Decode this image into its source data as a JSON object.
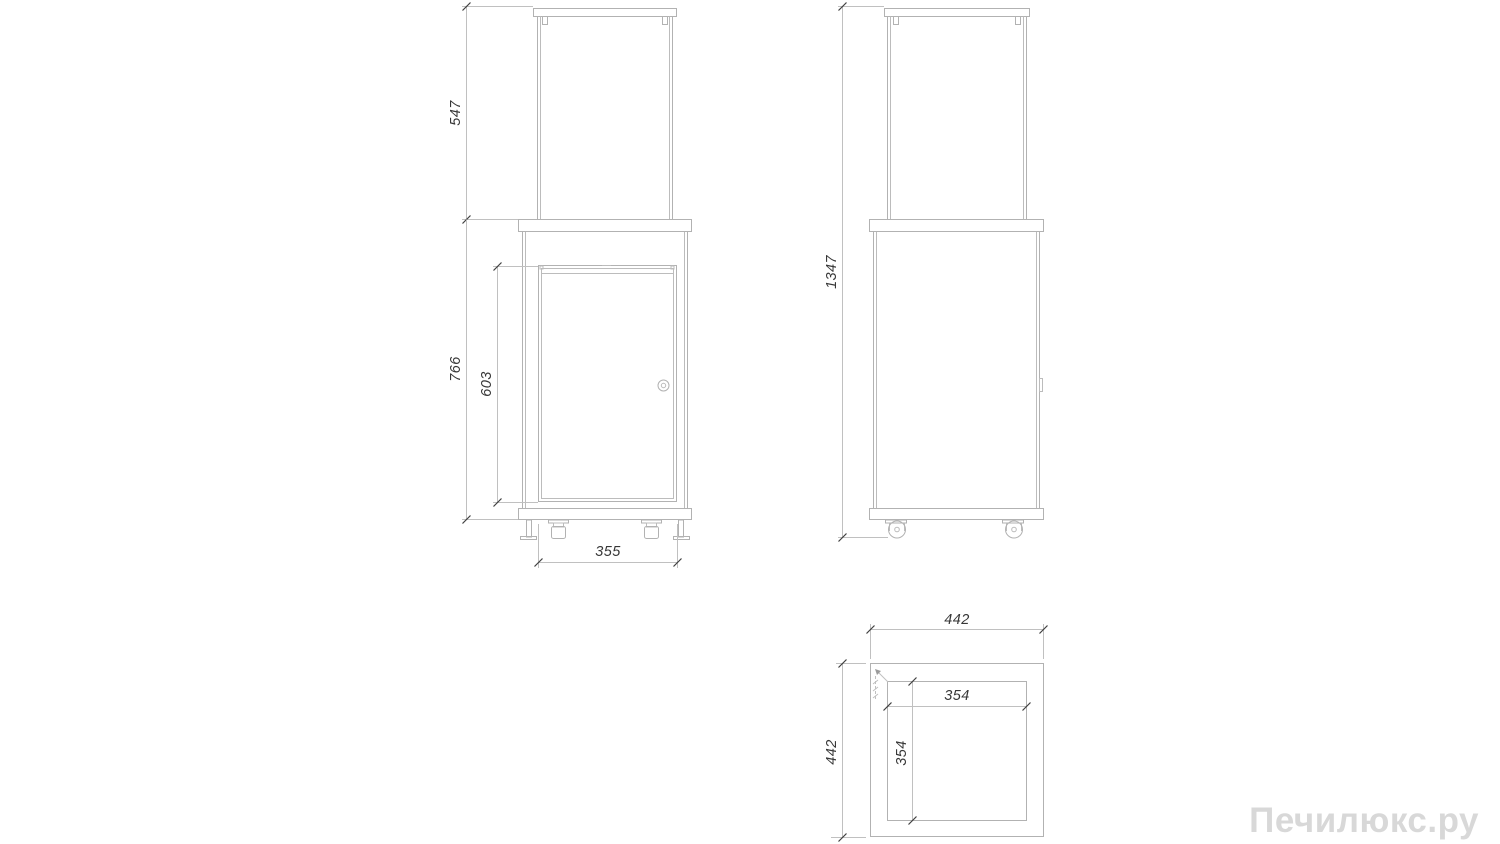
{
  "watermark": {
    "text": "Печилюкс.ру"
  },
  "views": {
    "front": {
      "label": "front view",
      "dims": {
        "glass_section_height": "547",
        "base_section_height": "766",
        "door_height": "603",
        "door_width": "355"
      }
    },
    "side": {
      "label": "side view",
      "dims": {
        "overall_height": "1347"
      }
    },
    "top": {
      "label": "top view",
      "dims": {
        "overall_width": "442",
        "overall_depth": "442",
        "glass_width": "354",
        "glass_depth": "354"
      }
    }
  },
  "colors": {
    "drawing_line": "#b2b2b2",
    "dimension_line": "#c0c0c0",
    "dimension_text": "#373737",
    "watermark_text": "#d8d8d8",
    "background": "#ffffff"
  }
}
